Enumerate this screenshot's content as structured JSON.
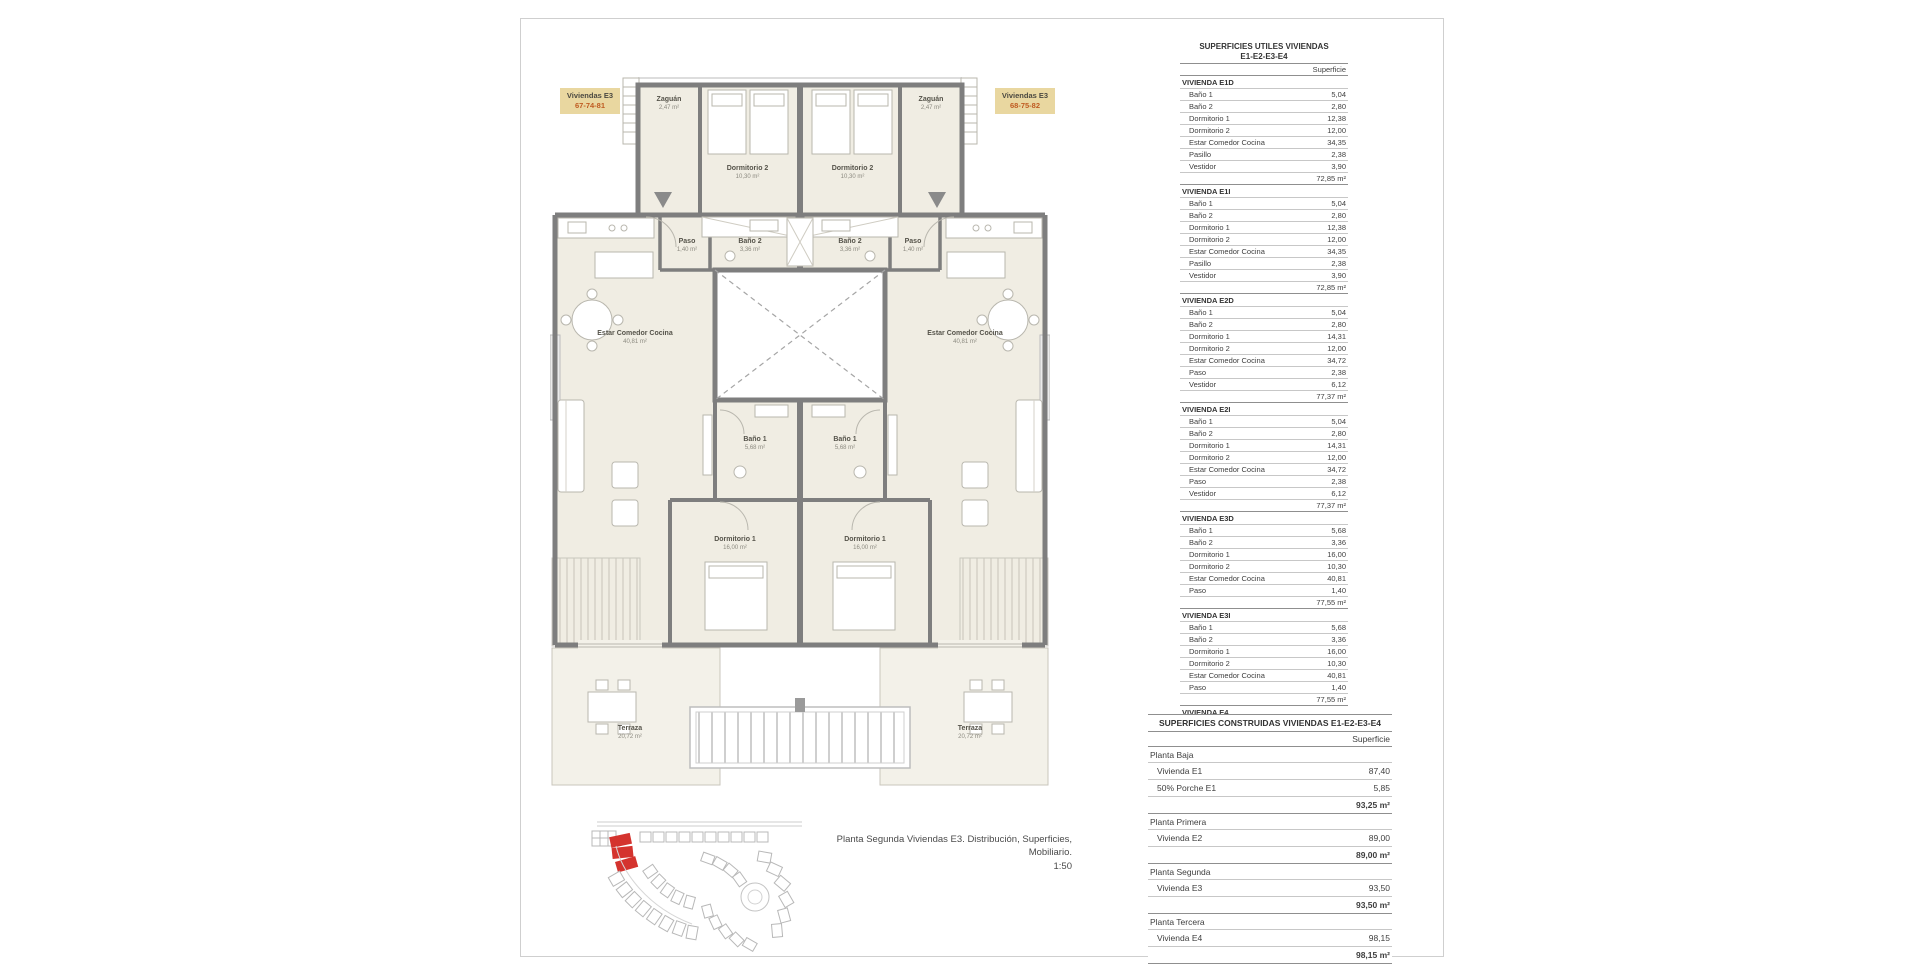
{
  "colors": {
    "accent_red": "#d4332e",
    "label_bg": "#e9d7a0",
    "label_number": "#bf5b21",
    "wall": "#7e7e7e",
    "room_fill": "#f0ede3"
  },
  "plan": {
    "unit_label_left": {
      "title": "Viviendas E3",
      "numbers": "67-74-81"
    },
    "unit_label_right": {
      "title": "Viviendas E3",
      "numbers": "68-75-82"
    },
    "rooms": {
      "zaguan": {
        "name": "Zaguán",
        "area": "2,47 m²"
      },
      "dormitorio2": {
        "name": "Dormitorio 2",
        "area": "10,30 m²"
      },
      "paso": {
        "name": "Paso",
        "area": "1,40 m²"
      },
      "bano2": {
        "name": "Baño 2",
        "area": "3,36 m²"
      },
      "estar": {
        "name": "Estar Comedor Cocina",
        "area": "40,81 m²"
      },
      "bano1": {
        "name": "Baño 1",
        "area": "5,68 m²"
      },
      "dormitorio1": {
        "name": "Dormitorio 1",
        "area": "16,00 m²"
      },
      "terraza": {
        "name": "Terraza",
        "area": "20,72 m²"
      }
    },
    "caption_line1": "Planta Segunda Viviendas E3. Distribución, Superficies, Mobiliario.",
    "caption_line2": "1:50"
  },
  "tables": {
    "superficies_utiles": {
      "title_line1": "SUPERFICIES UTILES VIVIENDAS",
      "title_line2": "E1-E2-E3-E4",
      "column_header": "Superficie",
      "sections": [
        {
          "name": "VIVIENDA E1D",
          "rows": [
            [
              "Baño 1",
              "5,04"
            ],
            [
              "Baño 2",
              "2,80"
            ],
            [
              "Dormitorio 1",
              "12,38"
            ],
            [
              "Dormitorio 2",
              "12,00"
            ],
            [
              "Estar Comedor Cocina",
              "34,35"
            ],
            [
              "Pasillo",
              "2,38"
            ],
            [
              "Vestidor",
              "3,90"
            ]
          ],
          "total": "72,85 m²"
        },
        {
          "name": "VIVIENDA E1I",
          "rows": [
            [
              "Baño 1",
              "5,04"
            ],
            [
              "Baño 2",
              "2,80"
            ],
            [
              "Dormitorio 1",
              "12,38"
            ],
            [
              "Dormitorio 2",
              "12,00"
            ],
            [
              "Estar Comedor Cocina",
              "34,35"
            ],
            [
              "Pasillo",
              "2,38"
            ],
            [
              "Vestidor",
              "3,90"
            ]
          ],
          "total": "72,85 m²"
        },
        {
          "name": "VIVIENDA E2D",
          "rows": [
            [
              "Baño 1",
              "5,04"
            ],
            [
              "Baño 2",
              "2,80"
            ],
            [
              "Dormitorio 1",
              "14,31"
            ],
            [
              "Dormitorio 2",
              "12,00"
            ],
            [
              "Estar Comedor Cocina",
              "34,72"
            ],
            [
              "Paso",
              "2,38"
            ],
            [
              "Vestidor",
              "6,12"
            ]
          ],
          "total": "77,37 m²"
        },
        {
          "name": "VIVIENDA E2I",
          "rows": [
            [
              "Baño 1",
              "5,04"
            ],
            [
              "Baño 2",
              "2,80"
            ],
            [
              "Dormitorio 1",
              "14,31"
            ],
            [
              "Dormitorio 2",
              "12,00"
            ],
            [
              "Estar Comedor Cocina",
              "34,72"
            ],
            [
              "Paso",
              "2,38"
            ],
            [
              "Vestidor",
              "6,12"
            ]
          ],
          "total": "77,37 m²"
        },
        {
          "name": "VIVIENDA E3D",
          "rows": [
            [
              "Baño 1",
              "5,68"
            ],
            [
              "Baño 2",
              "3,36"
            ],
            [
              "Dormitorio 1",
              "16,00"
            ],
            [
              "Dormitorio 2",
              "10,30"
            ],
            [
              "Estar Comedor Cocina",
              "40,81"
            ],
            [
              "Paso",
              "1,40"
            ]
          ],
          "total": "77,55 m²"
        },
        {
          "name": "VIVIENDA E3I",
          "rows": [
            [
              "Baño 1",
              "5,68"
            ],
            [
              "Baño 2",
              "3,36"
            ],
            [
              "Dormitorio 1",
              "16,00"
            ],
            [
              "Dormitorio 2",
              "10,30"
            ],
            [
              "Estar Comedor Cocina",
              "40,81"
            ],
            [
              "Paso",
              "1,40"
            ]
          ],
          "total": "77,55 m²"
        },
        {
          "name": "VIVIENDA E4",
          "rows": [
            [
              "Baño 1",
              "4,06"
            ],
            [
              "Baño 2",
              "3,22"
            ],
            [
              "Dormitorio 1",
              "15,30"
            ],
            [
              "Dormitorio 2",
              "9,68"
            ],
            [
              "Dormitorio 3",
              "8,79"
            ],
            [
              "Estar Comedor Cocina",
              "31,82"
            ],
            [
              "Pasillo",
              "6,07"
            ]
          ],
          "total": "78,94 m²"
        }
      ],
      "grand_total": "534,48 m²"
    },
    "superficies_construidas": {
      "title": "SUPERFICIES CONSTRUIDAS VIVIENDAS E1-E2-E3-E4",
      "column_header": "Superficie",
      "sections": [
        {
          "name": "Planta Baja",
          "rows": [
            [
              "Vivienda E1",
              "87,40"
            ],
            [
              "50% Porche E1",
              "5,85"
            ]
          ],
          "total": "93,25 m²"
        },
        {
          "name": "Planta Primera",
          "rows": [
            [
              "Vivienda E2",
              "89,00"
            ]
          ],
          "total": "89,00 m²"
        },
        {
          "name": "Planta Segunda",
          "rows": [
            [
              "Vivienda E3",
              "93,50"
            ]
          ],
          "total": "93,50 m²"
        },
        {
          "name": "Planta Tercera",
          "rows": [
            [
              "Vivienda E4",
              "98,15"
            ]
          ],
          "total": "98,15 m²"
        }
      ]
    }
  }
}
